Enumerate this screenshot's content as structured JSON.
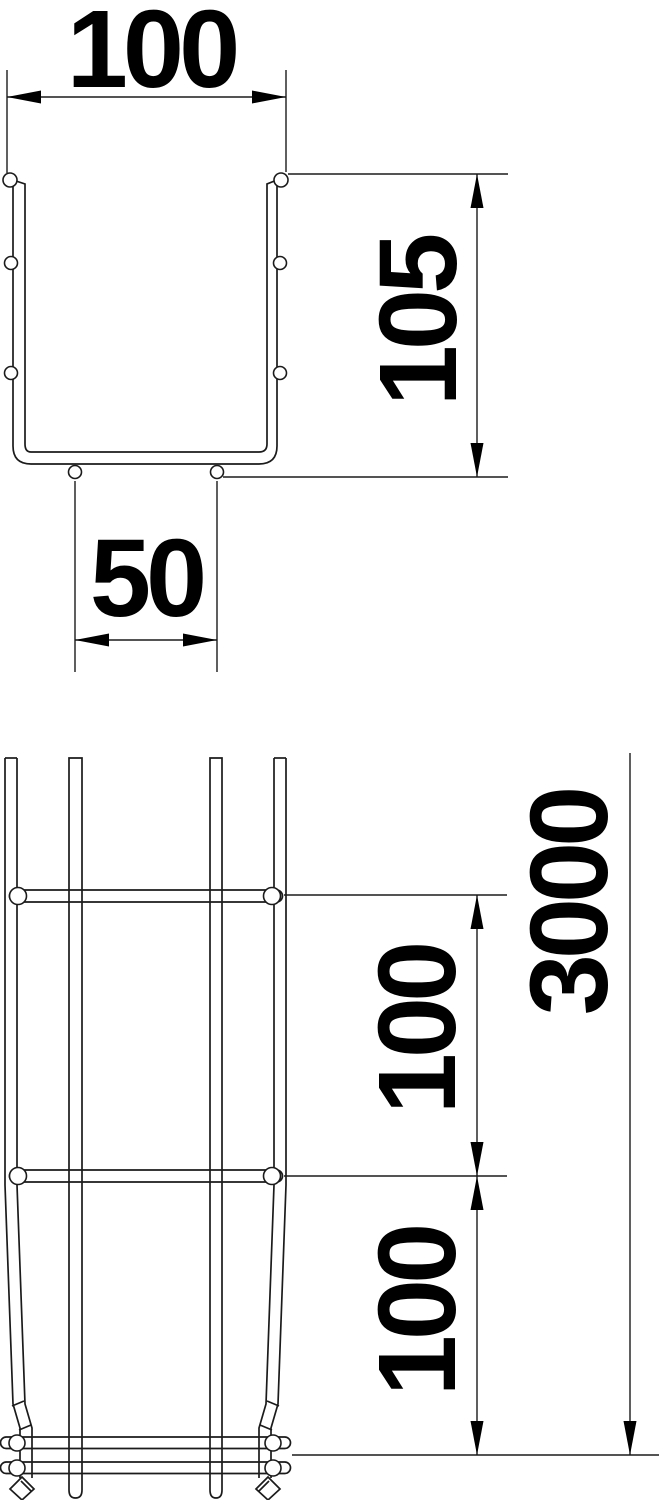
{
  "page": {
    "background_color": "#ffffff",
    "line_color": "#1b1b1b",
    "text_color": "#000000"
  },
  "drawing": {
    "kind": "technical-dimension-drawing",
    "views": {
      "cross_section": {
        "dimensions": {
          "outer_width": "100",
          "side_height": "105",
          "bottom_wire_spacing": "50"
        }
      },
      "plan_view": {
        "dimensions": {
          "mesh_pitch_upper": "100",
          "mesh_pitch_lower": "100",
          "total_length": "3000"
        }
      }
    }
  }
}
